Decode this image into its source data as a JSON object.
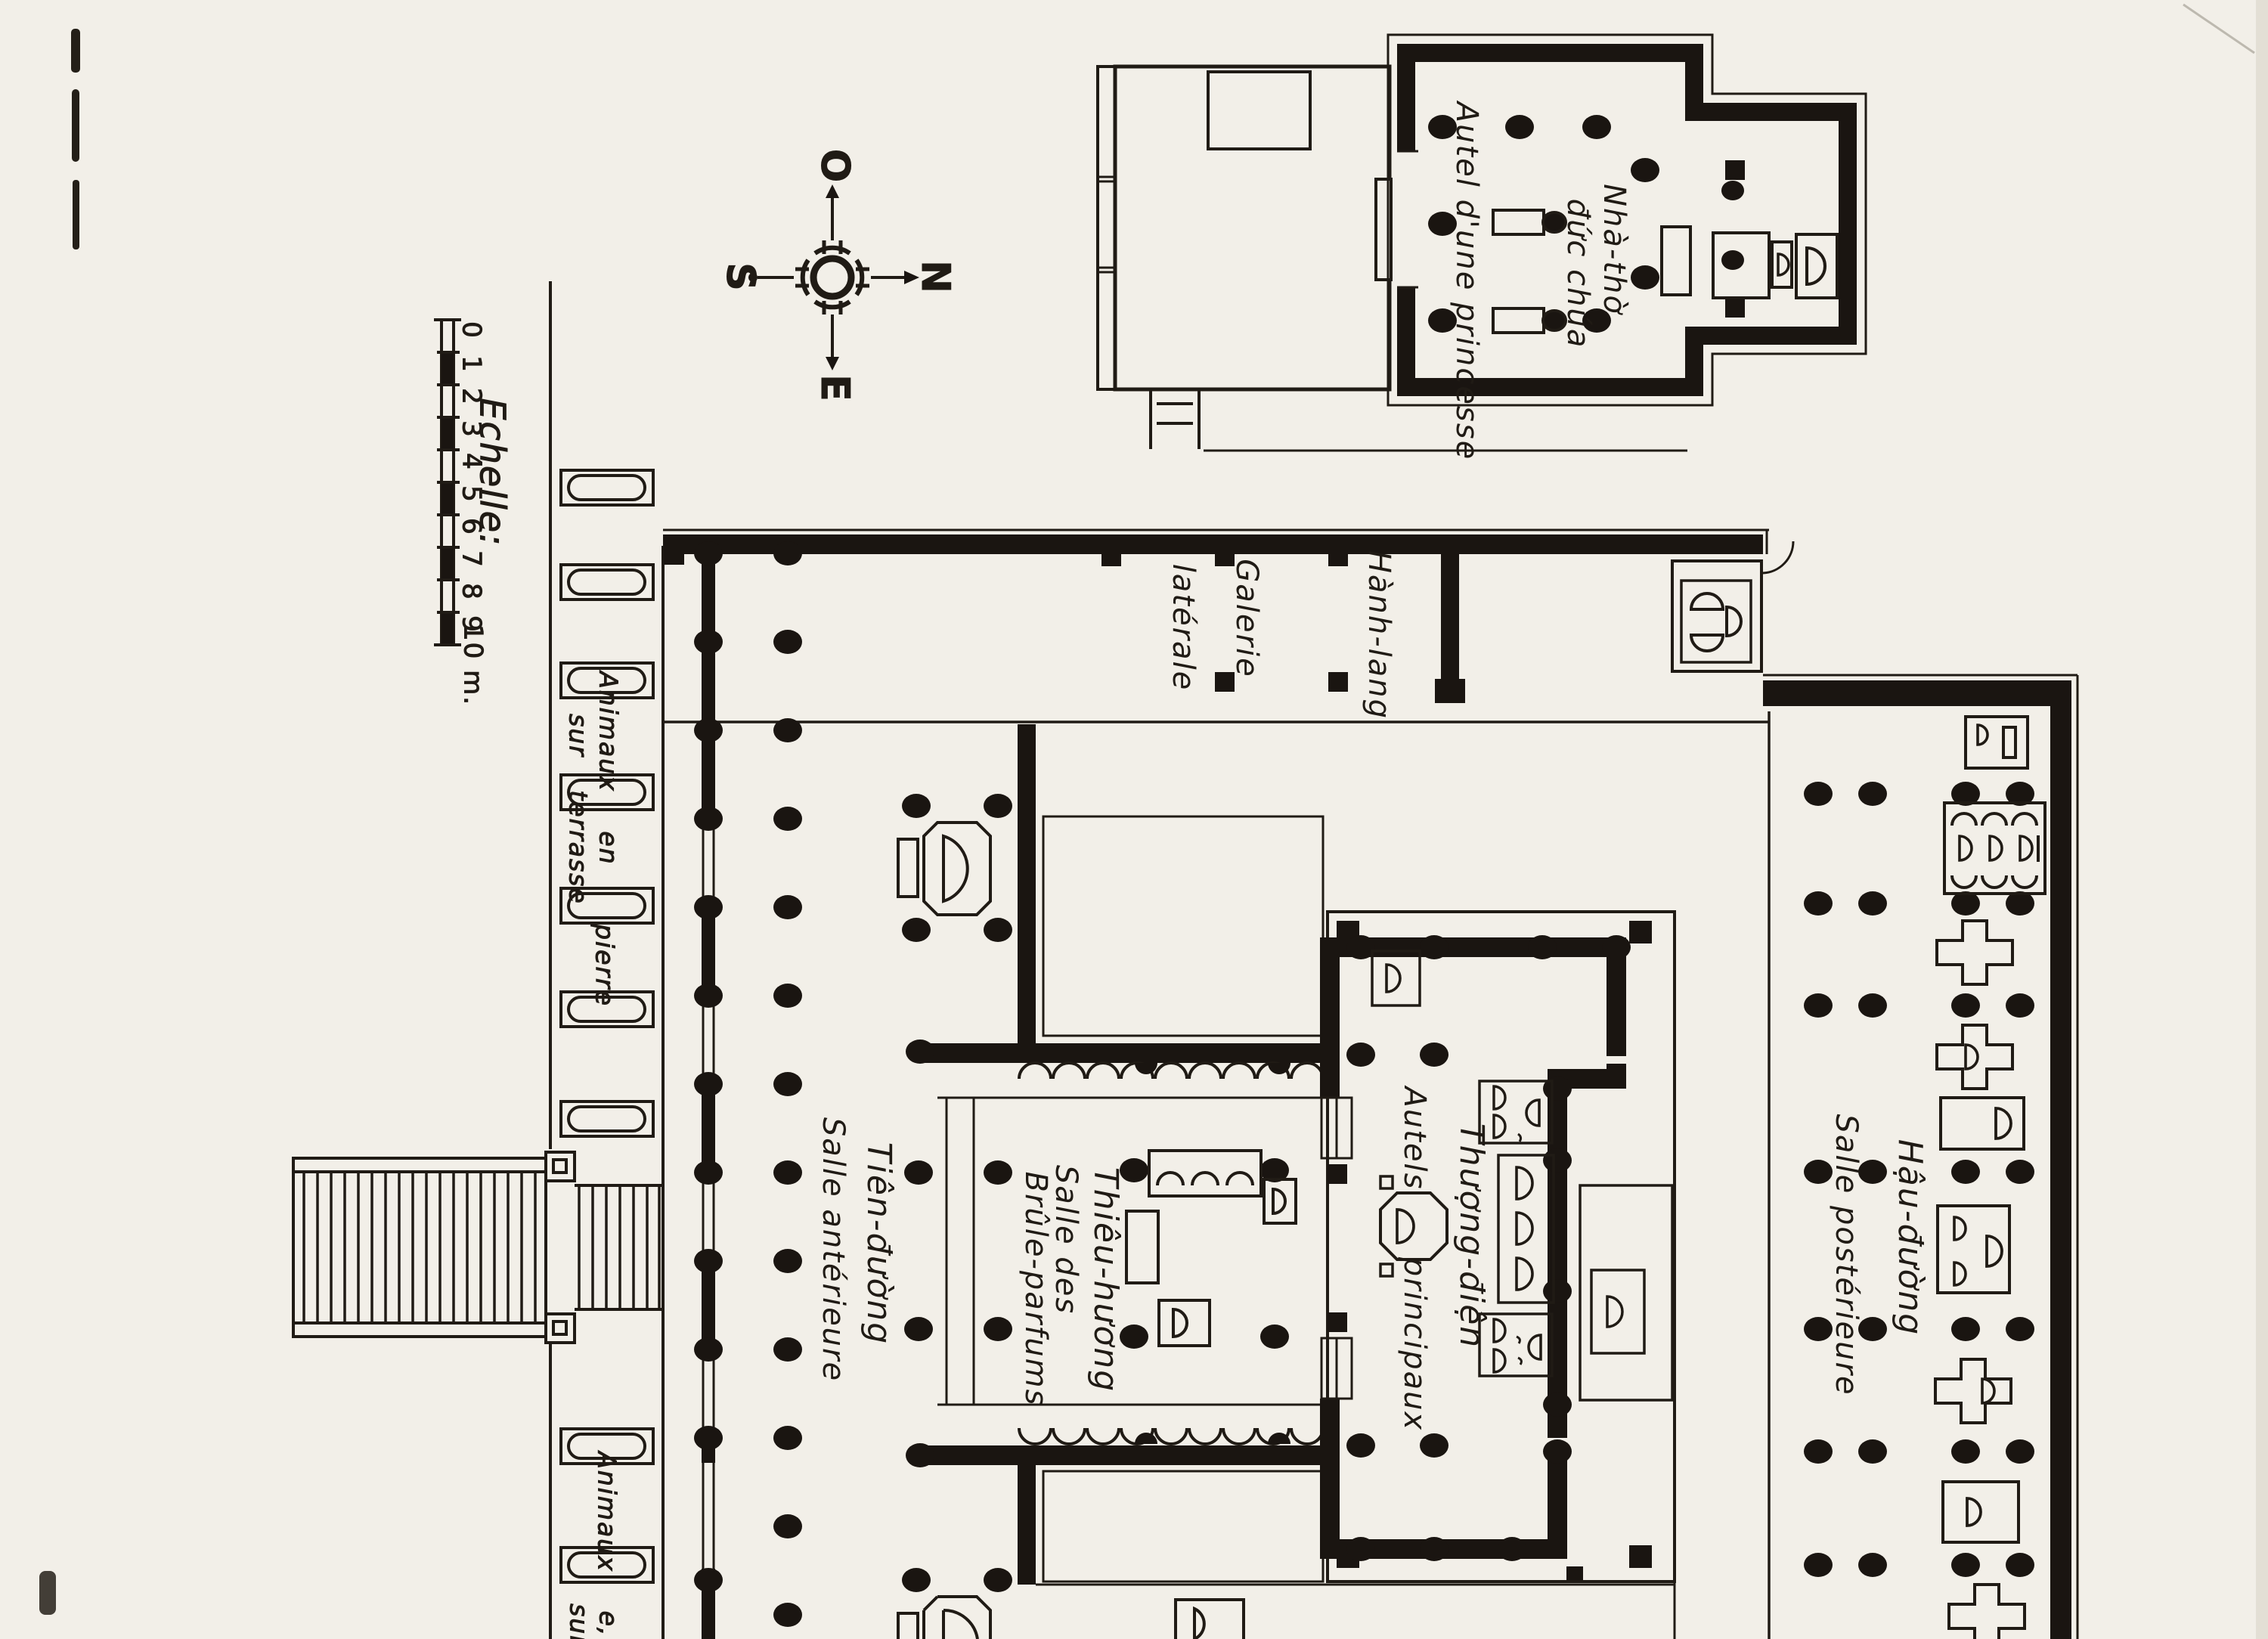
{
  "document": {
    "kind": "scanned architectural floor plan, hand lettered, plan rotated 90 degrees (north to the right)",
    "colors": {
      "paper": "#f2efe8",
      "ink": "#201b15",
      "wall": "#1a1511"
    }
  },
  "compass": {
    "west": "O",
    "south": "S",
    "north": "N",
    "east": "E"
  },
  "scale_bar": {
    "title": "Echelle:",
    "ticks": [
      "0",
      "1",
      "2",
      "3",
      "4",
      "5",
      "6",
      "7",
      "8",
      "9"
    ],
    "end_label": "10 m."
  },
  "labels": {
    "princess_shrine": {
      "name_line1": "Nhà-thờ",
      "name_line2": "đức chúa",
      "french": "Autel d'une princesse"
    },
    "gallery": {
      "french_line1": "Galerie",
      "french_line2": "latérale",
      "vietnamese": "Hành-lang"
    },
    "front_hall": {
      "vietnamese": "Tiên-đường",
      "french": "Salle antérieure"
    },
    "incense_hall": {
      "vietnamese": "Thiêu-hương",
      "french_line1": "Salle des",
      "french_line2": "Brûle-parfums"
    },
    "sanctuary": {
      "vietnamese": "Thượng-điện",
      "french_line1": "Autels",
      "french_line2": "principaux"
    },
    "rear_hall": {
      "vietnamese": "Hậu-đường",
      "french": "Salle postérieure"
    },
    "terrace": {
      "animaux": "Animaux",
      "sur": "sur",
      "terrasse": "terrasse",
      "en": "en",
      "pierre": "pierre"
    },
    "terrace_bottom": {
      "animaux": "Animaux",
      "sur": "sur",
      "partial": "e,"
    }
  }
}
